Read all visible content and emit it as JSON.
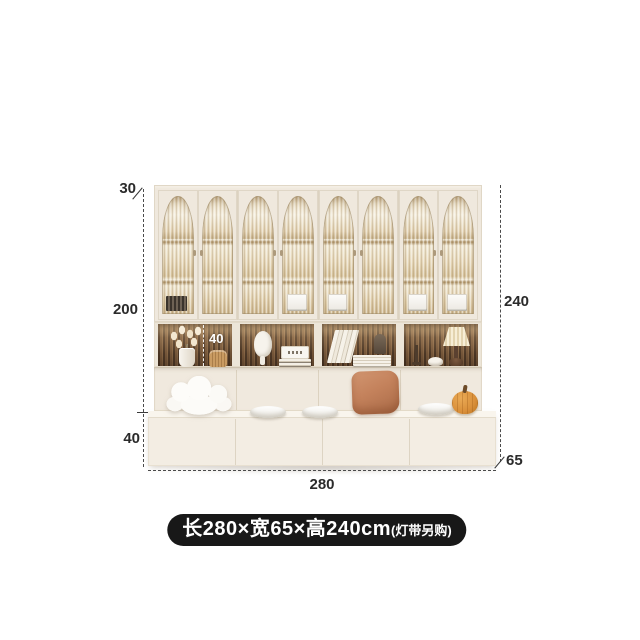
{
  "annotations": {
    "top_panel_depth": "30",
    "upper_section_height": "200",
    "shelf_inner_height": "40",
    "base_height": "40",
    "total_width": "280",
    "total_height": "240",
    "depth": "65"
  },
  "badge": {
    "size": "长280×宽65×高240cm",
    "note": "(灯带另购)"
  },
  "colors": {
    "cabinet_cream": "#efe8dd",
    "wood_slat_back": "#6f5236",
    "glass_warm": "#e9dcc0",
    "terracotta_pillow": "#c4825c",
    "pumpkin_orange": "#d98f3a",
    "badge_background": "#181818",
    "dimension_text": "#2b2b2b"
  }
}
